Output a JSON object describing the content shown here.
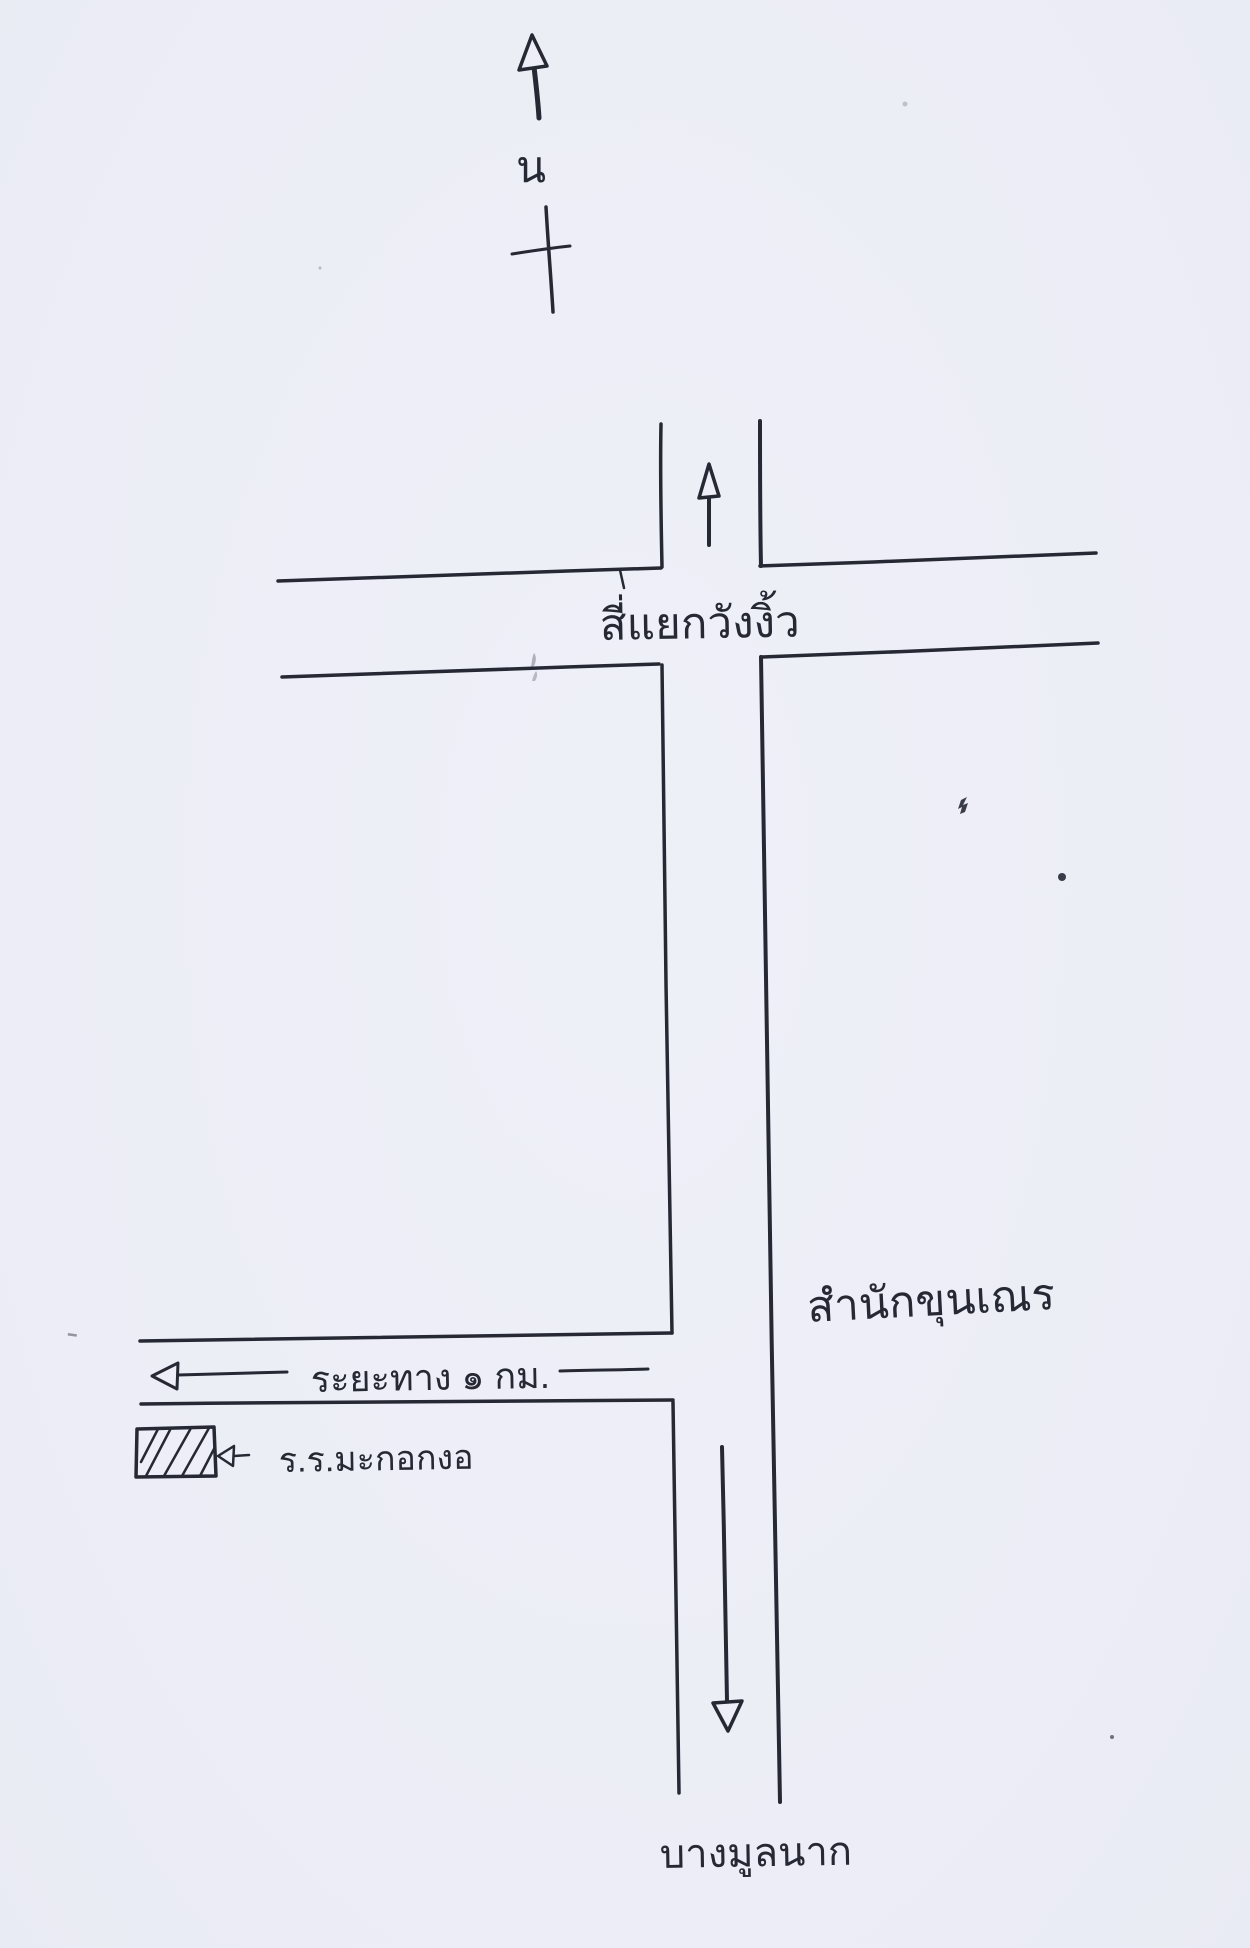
{
  "page": {
    "kind": "hand-drawn route sketch map",
    "paper_color": "#edeef7",
    "ink_color": "#262833"
  },
  "compass": {
    "north_label": "น"
  },
  "labels": {
    "intersection": "สี่แยกวังงิ้ว",
    "place_right": "สำนักขุนเณร",
    "distance": "ระยะทาง ๑ กม.",
    "school": "ร.ร.มะกอกงอ",
    "bottom_destination": "บางมูลนาก"
  }
}
